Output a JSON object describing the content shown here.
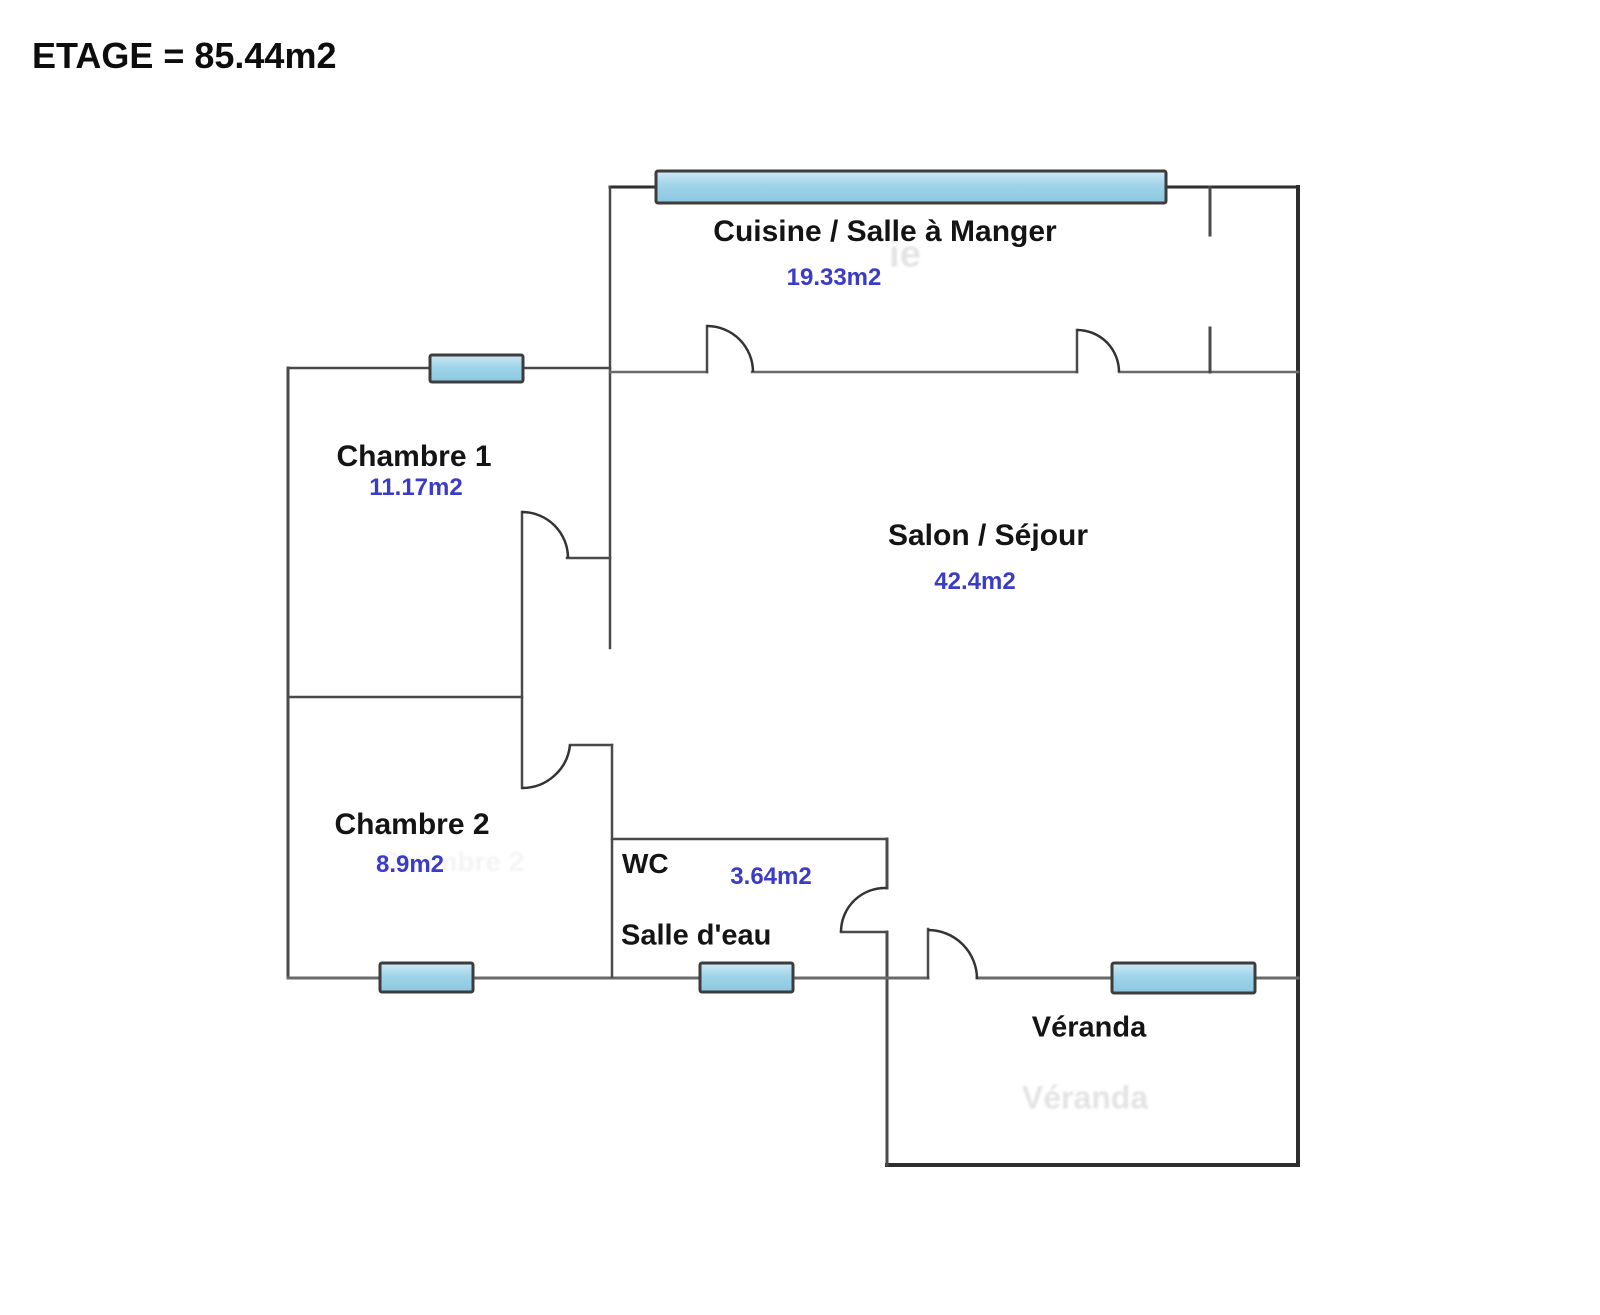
{
  "title": "ETAGE = 85.44m2",
  "rooms": {
    "cuisine": {
      "name": "Cuisine / Salle à Manger",
      "area": "19.33m2"
    },
    "chambre1": {
      "name": "Chambre 1",
      "area": "11.17m2"
    },
    "salon": {
      "name": "Salon / Séjour",
      "area": "42.4m2"
    },
    "chambre2": {
      "name": "Chambre 2",
      "area": "8.9m2"
    },
    "wc": {
      "name": "WC",
      "area": "3.64m2"
    },
    "salle_eau": {
      "name": "Salle d'eau"
    },
    "veranda": {
      "name": "Véranda"
    }
  },
  "watermarks": {
    "cuisine_ghost": "ie",
    "chambre2_ghost": "Chambre 2",
    "veranda_ghost": "Véranda"
  },
  "colors": {
    "wall": "#3f3f3f",
    "window_fill": "#9ed3e9",
    "window_border": "#3c3c3c",
    "room_label": "#141414",
    "area_value": "#3b3bc9"
  }
}
